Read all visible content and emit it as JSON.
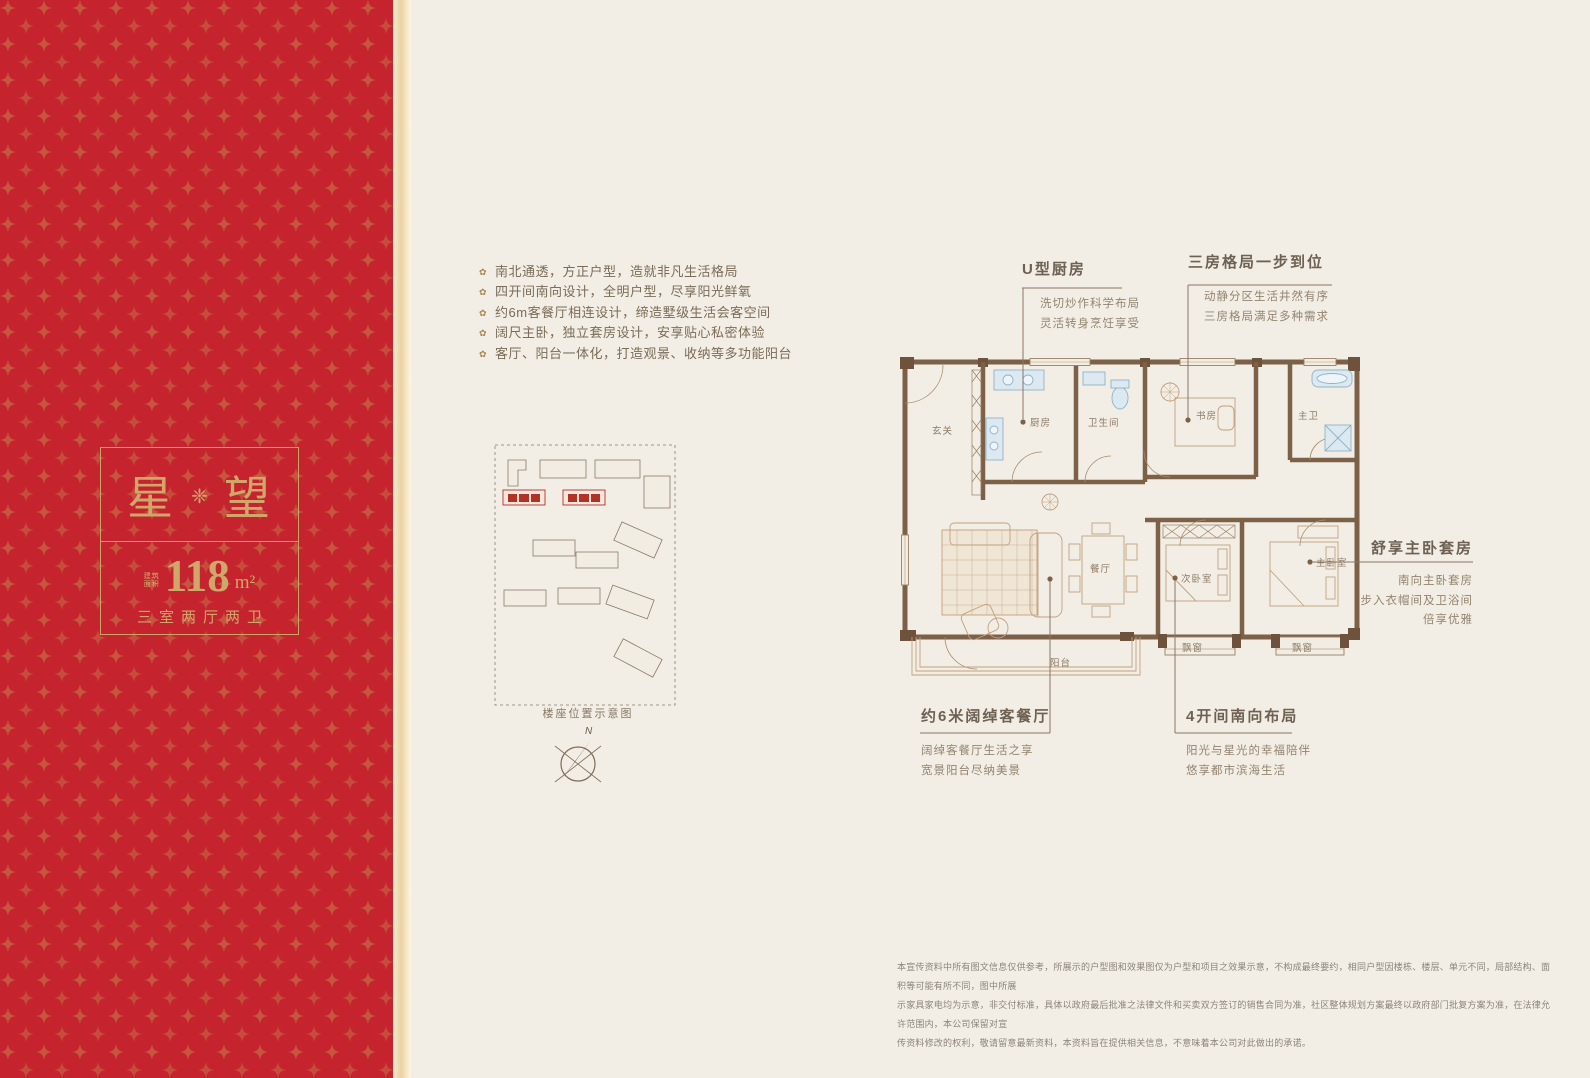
{
  "panel": {
    "title_left": "星",
    "title_right": "望",
    "ornament": "❈",
    "area_label_1": "建筑",
    "area_label_2": "面积",
    "area_value": "118",
    "area_unit": "m²",
    "layout": "三室两厅两卫",
    "red": "#c5242e",
    "gold": "#cfa76b"
  },
  "features": {
    "bullet": "✿",
    "items": [
      "南北通透，方正户型，造就非凡生活格局",
      "四开间南向设计，全明户型，尽享阳光鲜氧",
      "约6m客餐厅相连设计，缔造墅级生活会客空间",
      "阔尺主卧，独立套房设计，安享贴心私密体验",
      "客厅、阳台一体化，打造观景、收纳等多功能阳台"
    ]
  },
  "siteplan": {
    "caption": "楼座位置示意图",
    "compass_n": "N"
  },
  "plan": {
    "rooms": {
      "entry": "玄关",
      "kitchen": "厨房",
      "bath": "卫生间",
      "study": "书房",
      "master_bath": "主卫",
      "dining": "餐厅",
      "bedroom2": "次卧室",
      "master_bedroom": "主卧室",
      "balcony": "阳台",
      "bay1": "飘窗",
      "bay2": "飘窗"
    }
  },
  "annotations": {
    "kitchen": {
      "title": "U型厨房",
      "line1": "洗切炒作科学布局",
      "line2": "灵活转身烹饪享受"
    },
    "rooms3": {
      "title": "三房格局一步到位",
      "line1": "动静分区生活井然有序",
      "line2": "三房格局满足多种需求"
    },
    "master": {
      "title": "舒享主卧套房",
      "line1": "南向主卧套房",
      "line2": "步入衣帽间及卫浴间",
      "line3": "倍享优雅"
    },
    "living": {
      "title": "约6米阔绰客餐厅",
      "line1": "阔绰客餐厅生活之享",
      "line2": "宽景阳台尽纳美景"
    },
    "south": {
      "title": "4开间南向布局",
      "line1": "阳光与星光的幸福陪伴",
      "line2": "悠享都市滨海生活"
    }
  },
  "disclaimer": {
    "line1": "本宣传资料中所有图文信息仅供参考，所展示的户型图和效果图仅为户型和项目之效果示意，不构成最终要约，相同户型因楼栋、楼层、单元不同，局部结构、面积等可能有所不同，图中所展",
    "line2": "示家具家电均为示意，非交付标准，具体以政府最后批准之法律文件和买卖双方签订的销售合同为准，社区整体规划方案最终以政府部门批复方案为准，在法律允许范围内，本公司保留对宣",
    "line3": "传资料修改的权利，敬请留意最新资料，本资料旨在提供相关信息，不意味着本公司对此做出的承诺。"
  }
}
